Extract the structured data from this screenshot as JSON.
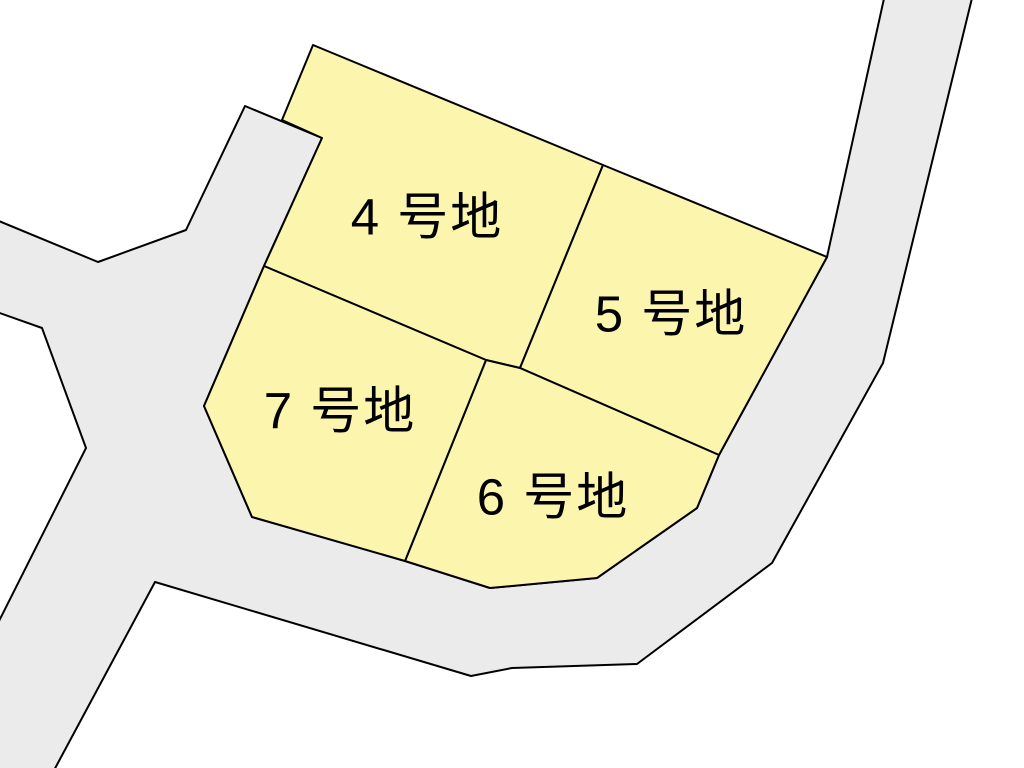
{
  "map": {
    "title": "subdivision-lot-plan",
    "background_color": "#ffffff",
    "road_color": "#ebebeb",
    "lot_fill_color": "#fcf5ae",
    "outline_color": "#000000",
    "outline_width": 2,
    "label_font_size": 51,
    "label_color": "#000000",
    "road": {
      "name": "road-area",
      "points": [
        [
          245,
          106
        ],
        [
          322,
          138
        ],
        [
          264,
          266
        ],
        [
          204,
          406
        ],
        [
          252,
          517
        ],
        [
          405,
          561
        ],
        [
          490,
          588
        ],
        [
          597,
          578
        ],
        [
          697,
          508
        ],
        [
          719,
          455
        ],
        [
          827,
          257
        ],
        [
          885,
          -6
        ],
        [
          973,
          -6
        ],
        [
          883,
          363
        ],
        [
          772,
          563
        ],
        [
          637,
          664
        ],
        [
          512,
          668
        ],
        [
          471,
          676
        ],
        [
          155,
          582
        ],
        [
          52,
          774
        ],
        [
          -6,
          774
        ],
        [
          -6,
          631
        ],
        [
          86,
          448
        ],
        [
          42,
          328
        ],
        [
          -6,
          311
        ],
        [
          -6,
          219
        ],
        [
          98,
          262
        ],
        [
          186,
          230
        ]
      ]
    },
    "lots": [
      {
        "id": "lot-4",
        "label": "4 号地",
        "label_x": 427,
        "label_y": 217,
        "points": [
          [
            313,
            45
          ],
          [
            603,
            165
          ],
          [
            520,
            368
          ],
          [
            486,
            360
          ],
          [
            264,
            266
          ],
          [
            322,
            138
          ],
          [
            282,
            120
          ]
        ]
      },
      {
        "id": "lot-5",
        "label": "5 号地",
        "label_x": 671,
        "label_y": 314,
        "points": [
          [
            603,
            165
          ],
          [
            827,
            257
          ],
          [
            719,
            455
          ],
          [
            520,
            368
          ]
        ]
      },
      {
        "id": "lot-6",
        "label": "6 号地",
        "label_x": 553,
        "label_y": 497,
        "points": [
          [
            486,
            360
          ],
          [
            520,
            368
          ],
          [
            719,
            455
          ],
          [
            697,
            508
          ],
          [
            597,
            578
          ],
          [
            490,
            588
          ],
          [
            405,
            561
          ]
        ]
      },
      {
        "id": "lot-7",
        "label": "7 号地",
        "label_x": 340,
        "label_y": 411,
        "points": [
          [
            264,
            266
          ],
          [
            486,
            360
          ],
          [
            405,
            561
          ],
          [
            252,
            517
          ],
          [
            204,
            406
          ]
        ]
      }
    ]
  }
}
